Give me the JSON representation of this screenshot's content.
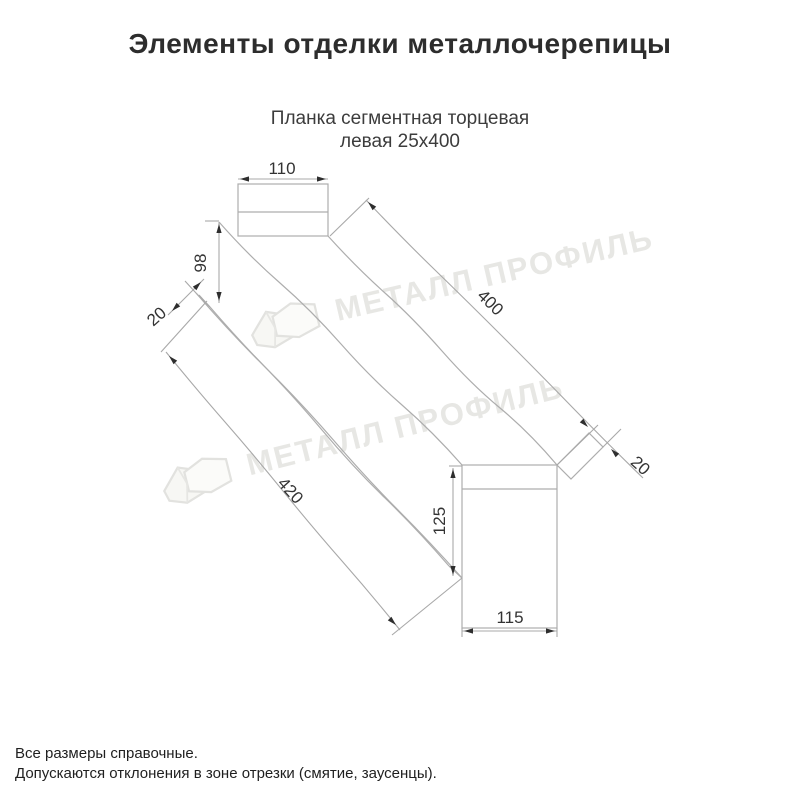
{
  "page": {
    "title": "Элементы отделки металлочерепицы",
    "subtitle": {
      "line1": "Планка сегментная торцевая",
      "line2": "левая 25х400"
    },
    "footer": {
      "line1": "Все размеры справочные.",
      "line2": "Допускаются отклонения в зоне отрезки (смятие, заусенцы)."
    }
  },
  "watermark": {
    "brand": "МЕТАЛЛ ПРОФИЛЬ"
  },
  "drawing": {
    "part_name": "Планка сегментная торцевая левая 25х400",
    "dimensions": {
      "top_flange_width": "110",
      "back_height": "98",
      "left_hem": "20",
      "top_edge_length": "400",
      "right_hem": "20",
      "bottom_edge_length": "420",
      "end_face_height": "125",
      "end_face_width": "115"
    }
  },
  "colors": {
    "drawing_line": "#a8a8a8",
    "dimension_text": "#333333",
    "watermark": "#e7e7e4",
    "title_text": "#2d2d2d"
  }
}
